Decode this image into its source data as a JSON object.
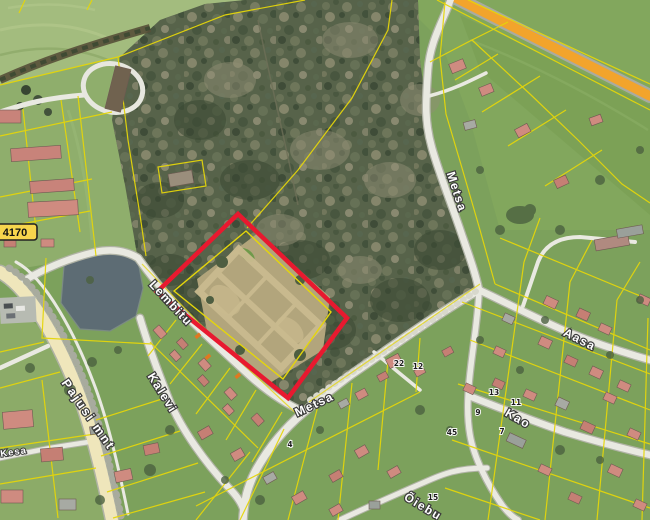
{
  "map": {
    "road_badge": {
      "number": "4170"
    },
    "streets": {
      "pajusi": "Pajusi mnt",
      "lembitu": "Lembitu",
      "kalevi": "Kalevi",
      "metsa_north": "Metsa",
      "metsa_south": "Metsa",
      "aasa": "Aasa",
      "kao": "Kao",
      "kesa": "Kesa",
      "oiebu": "Õiebu"
    },
    "house_numbers": [
      "22",
      "12",
      "13",
      "11",
      "9",
      "7",
      "45",
      "4",
      "15"
    ],
    "colors": {
      "selection_outline": "#e8192f",
      "cadastral_line": "#e5d60a",
      "highway_fill": "#f2a42c",
      "water": "#5d6c74"
    }
  }
}
